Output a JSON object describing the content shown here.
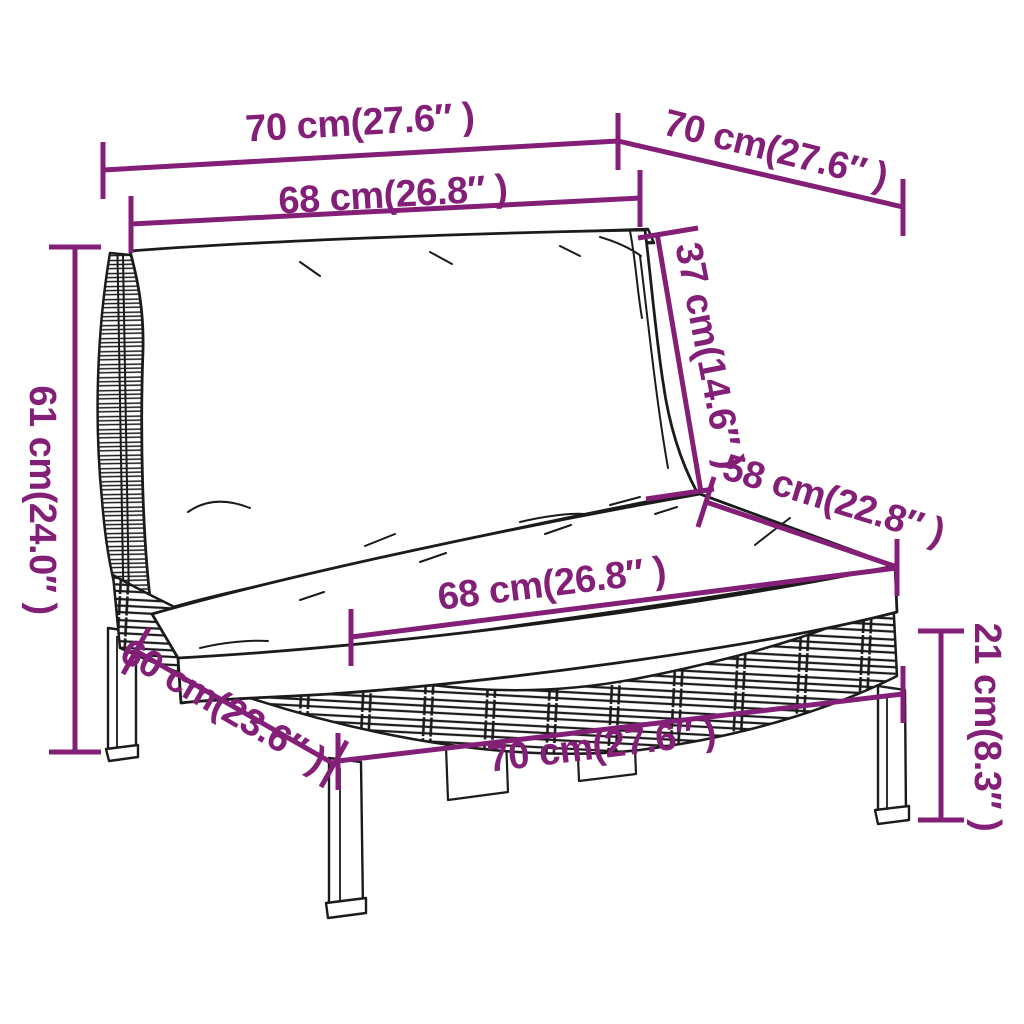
{
  "figure": {
    "type": "product-dimension-diagram",
    "subject": "half-round-poly-rattan-sofa-section-with-cushions"
  },
  "colors": {
    "accent": "#841F78",
    "line": "#1b1b1b",
    "background": "#ffffff"
  },
  "dimensions": [
    {
      "id": "top-width",
      "label": "70 cm(27.6″ )"
    },
    {
      "id": "top-depth",
      "label": "70 cm(27.6″ )"
    },
    {
      "id": "back-width",
      "label": "68 cm(26.8″ )"
    },
    {
      "id": "back-height",
      "label": "37 cm(14.6″ )"
    },
    {
      "id": "left-height",
      "label": "61 cm(24.0″ )"
    },
    {
      "id": "seat-depth-right",
      "label": "58 cm(22.8″ )"
    },
    {
      "id": "seat-width",
      "label": "68 cm(26.8″ )"
    },
    {
      "id": "seat-depth-left",
      "label": "60 cm(23.6″ )"
    },
    {
      "id": "bottom-width",
      "label": "70 cm(27.6″ )"
    },
    {
      "id": "leg-height",
      "label": "21 cm(8.3″ )"
    }
  ]
}
